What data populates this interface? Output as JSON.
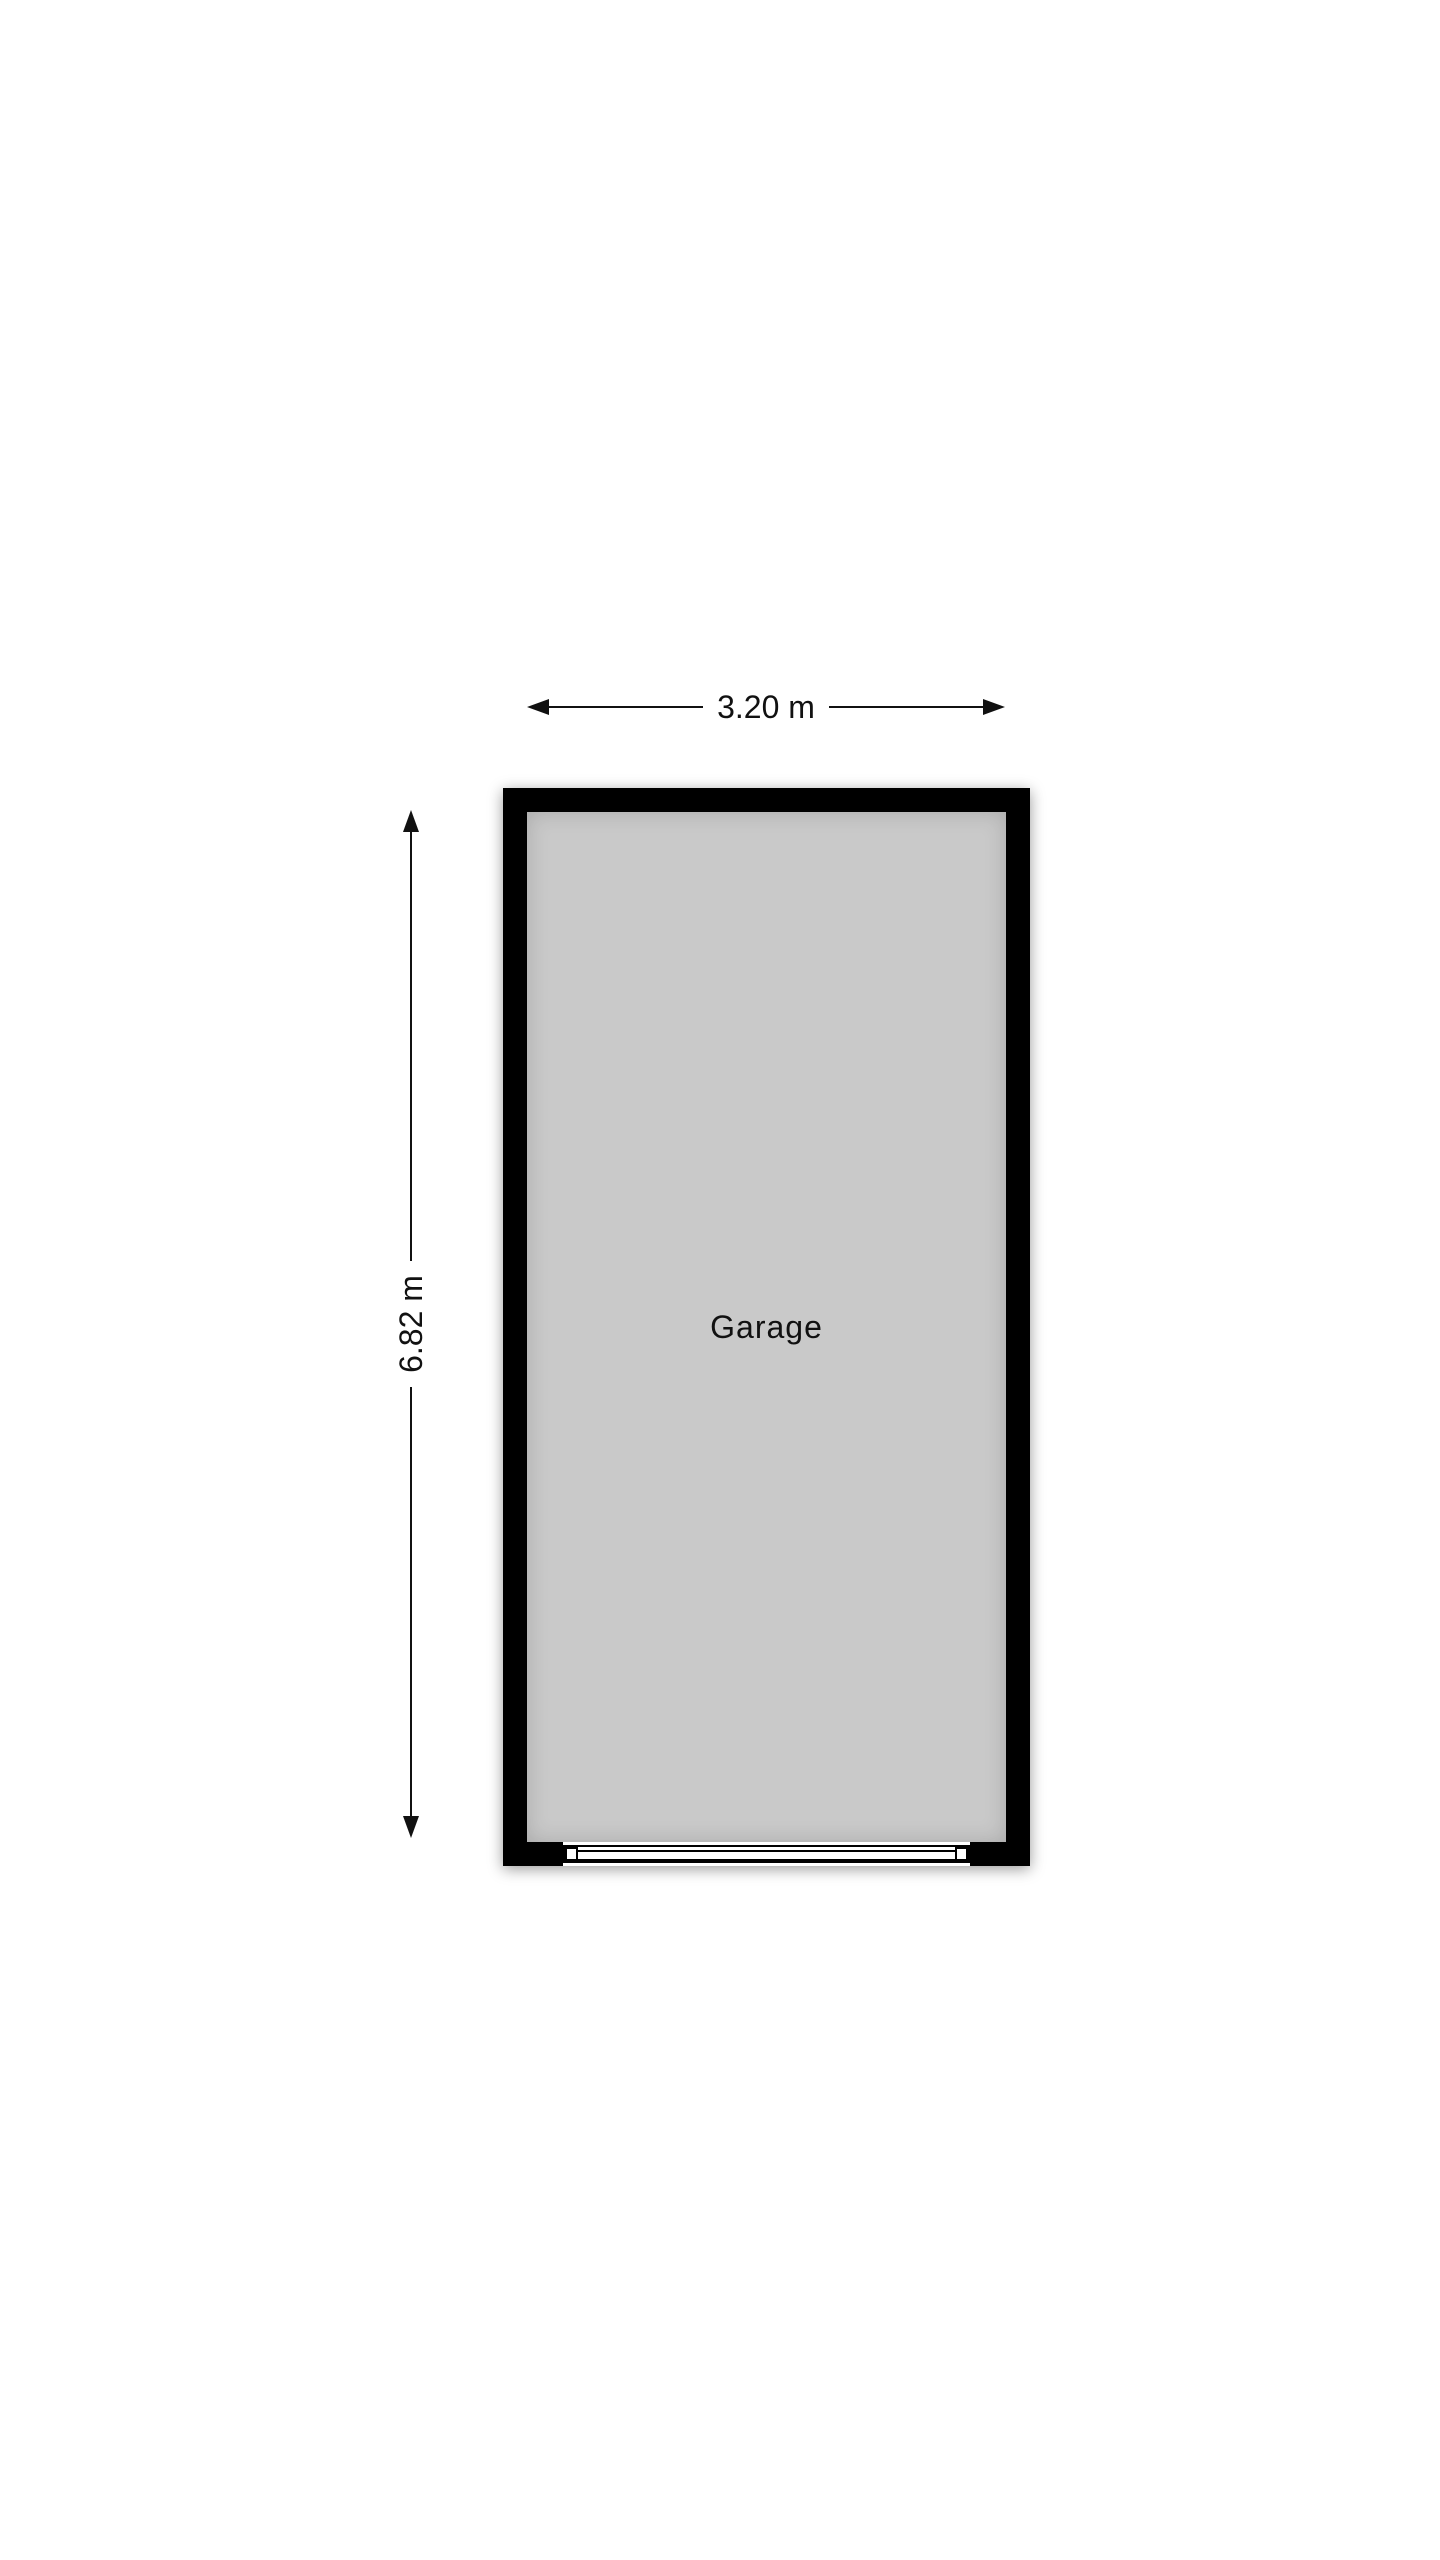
{
  "floorplan": {
    "room": {
      "label": "Garage"
    },
    "dimensions": {
      "width": {
        "label": "3.20 m"
      },
      "height": {
        "label": "6.82 m"
      }
    },
    "colors": {
      "background": "#ffffff",
      "wall": "#000000",
      "floor": "#c9c9c9",
      "line": "#111111",
      "door": "#ffffff"
    }
  }
}
